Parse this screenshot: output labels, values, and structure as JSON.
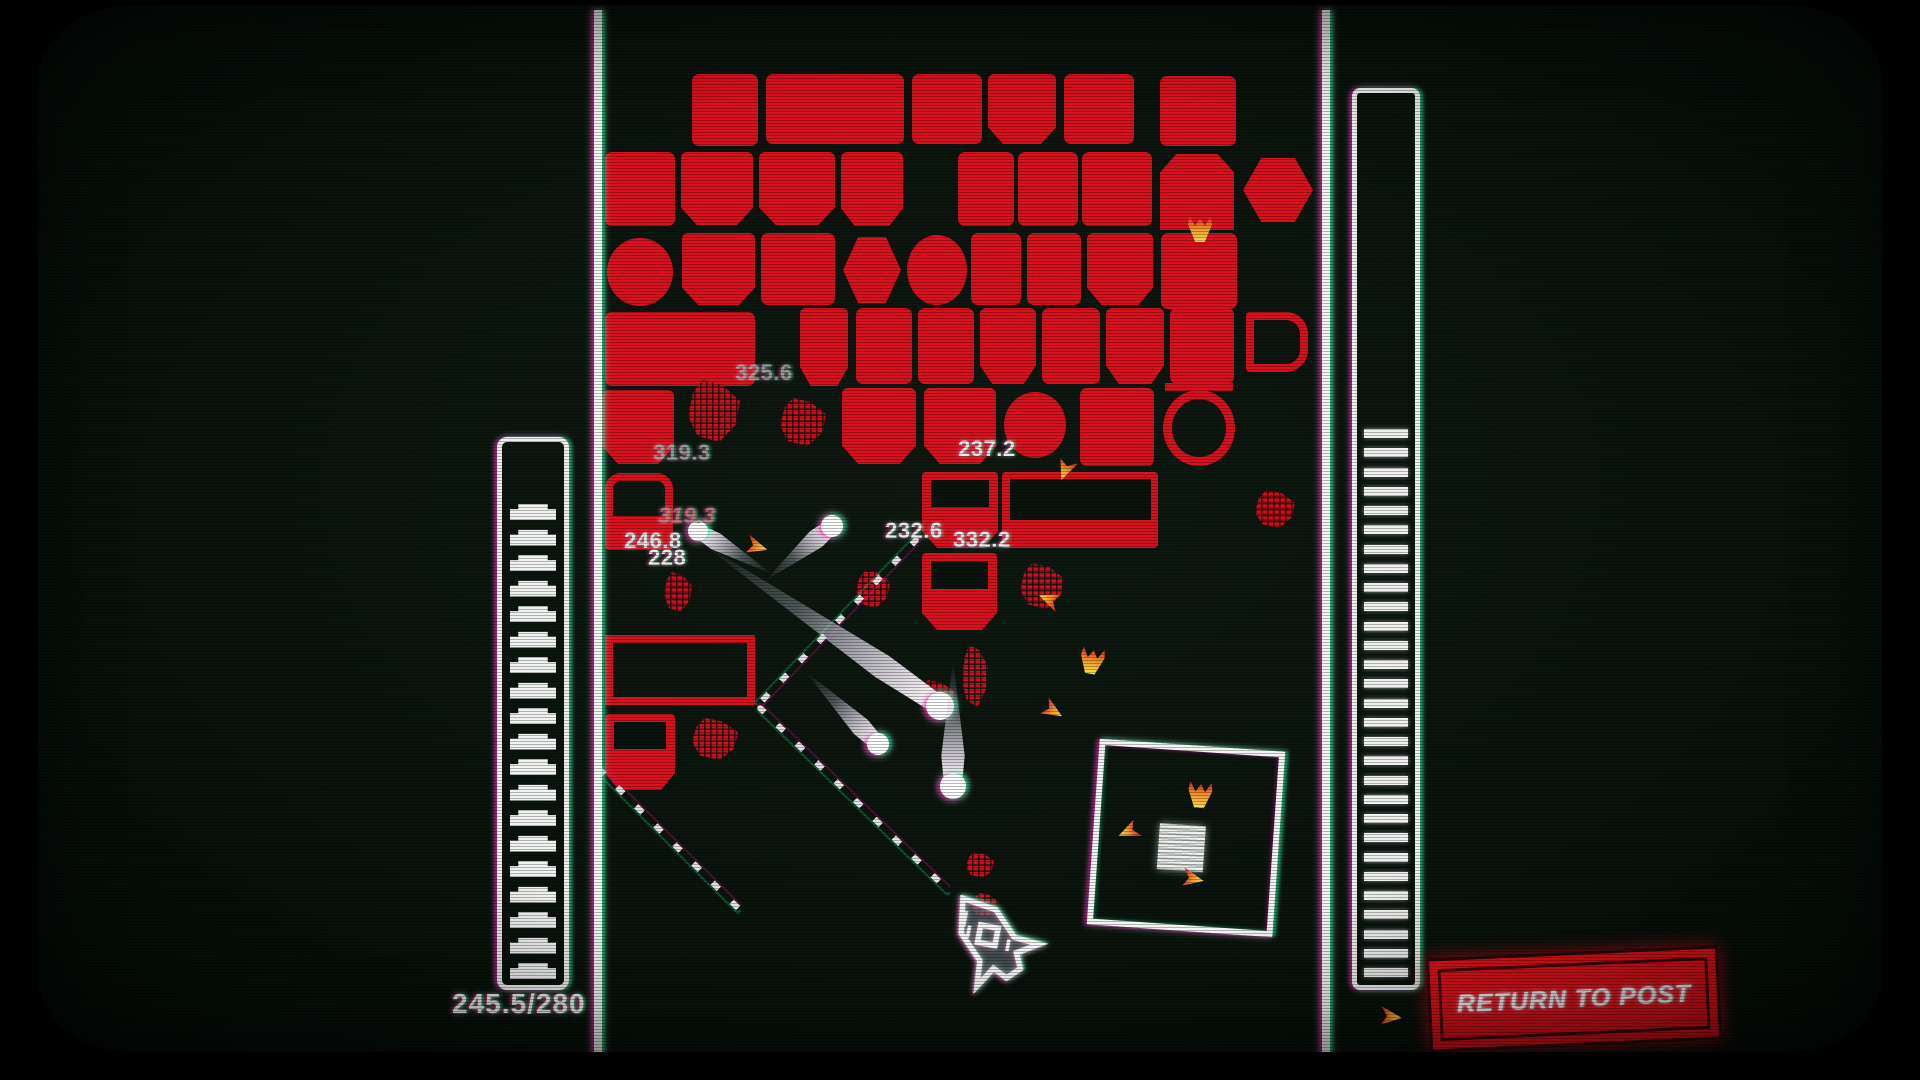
{
  "hud": {
    "ammo_label": "245.5/280",
    "ammo_segments": 19,
    "right_gauge_bars": 29,
    "return_button": "RETURN TO POST"
  },
  "colors": {
    "background": "#0a140d",
    "block_red": "#d8111e",
    "button_red": "#e8131d",
    "white": "#f2f4f3",
    "flame_orange": "#f08f25",
    "flame_yellow": "#ffe14e"
  },
  "walls": {
    "left_x": 594,
    "right_x": 1322
  },
  "labels": [
    {
      "text": "325.6",
      "x": 735,
      "y": 360,
      "cls": "dim"
    },
    {
      "text": "319.3",
      "x": 653,
      "y": 440,
      "cls": "dim"
    },
    {
      "text": "237.2",
      "x": 958,
      "y": 436,
      "cls": ""
    },
    {
      "text": "319.3",
      "x": 658,
      "y": 503,
      "cls": "ital"
    },
    {
      "text": "246.8",
      "x": 624,
      "y": 528,
      "cls": ""
    },
    {
      "text": "228",
      "x": 648,
      "y": 545,
      "cls": ""
    },
    {
      "text": "232.6",
      "x": 885,
      "y": 518,
      "cls": ""
    },
    {
      "text": "332.2",
      "x": 953,
      "y": 527,
      "cls": ""
    }
  ],
  "blocks": [
    {
      "x": 692,
      "y": 74,
      "w": 66,
      "h": 72,
      "s": "sq"
    },
    {
      "x": 766,
      "y": 74,
      "w": 138,
      "h": 70,
      "s": "sq"
    },
    {
      "x": 912,
      "y": 74,
      "w": 70,
      "h": 70,
      "s": "sq"
    },
    {
      "x": 988,
      "y": 74,
      "w": 68,
      "h": 70,
      "s": "octb"
    },
    {
      "x": 1064,
      "y": 74,
      "w": 70,
      "h": 70,
      "s": "sq"
    },
    {
      "x": 1160,
      "y": 76,
      "w": 76,
      "h": 70,
      "s": "sq"
    },
    {
      "x": 605,
      "y": 152,
      "w": 70,
      "h": 74,
      "s": "sq"
    },
    {
      "x": 681,
      "y": 152,
      "w": 72,
      "h": 73,
      "s": "octb"
    },
    {
      "x": 759,
      "y": 152,
      "w": 76,
      "h": 73,
      "s": "octb"
    },
    {
      "x": 841,
      "y": 152,
      "w": 62,
      "h": 74,
      "s": "octb"
    },
    {
      "x": 958,
      "y": 152,
      "w": 56,
      "h": 74,
      "s": "sq"
    },
    {
      "x": 1018,
      "y": 152,
      "w": 60,
      "h": 74,
      "s": "sq"
    },
    {
      "x": 1082,
      "y": 152,
      "w": 70,
      "h": 74,
      "s": "sq"
    },
    {
      "x": 1160,
      "y": 154,
      "w": 74,
      "h": 76,
      "s": "octt"
    },
    {
      "x": 1243,
      "y": 158,
      "w": 70,
      "h": 64,
      "s": "hex"
    },
    {
      "x": 607,
      "y": 238,
      "w": 66,
      "h": 68,
      "s": "circle"
    },
    {
      "x": 682,
      "y": 233,
      "w": 73,
      "h": 72,
      "s": "octb"
    },
    {
      "x": 761,
      "y": 233,
      "w": 74,
      "h": 72,
      "s": "sq"
    },
    {
      "x": 843,
      "y": 237,
      "w": 58,
      "h": 66,
      "s": "hex"
    },
    {
      "x": 907,
      "y": 235,
      "w": 60,
      "h": 70,
      "s": "circle"
    },
    {
      "x": 971,
      "y": 233,
      "w": 50,
      "h": 72,
      "s": "sq"
    },
    {
      "x": 1027,
      "y": 233,
      "w": 54,
      "h": 72,
      "s": "sq"
    },
    {
      "x": 1087,
      "y": 233,
      "w": 66,
      "h": 72,
      "s": "octb"
    },
    {
      "x": 1161,
      "y": 233,
      "w": 76,
      "h": 76,
      "s": "sq"
    },
    {
      "x": 605,
      "y": 312,
      "w": 150,
      "h": 74,
      "s": "sq"
    },
    {
      "x": 800,
      "y": 308,
      "w": 48,
      "h": 78,
      "s": "octb"
    },
    {
      "x": 856,
      "y": 308,
      "w": 56,
      "h": 76,
      "s": "sq"
    },
    {
      "x": 918,
      "y": 308,
      "w": 56,
      "h": 76,
      "s": "sq"
    },
    {
      "x": 980,
      "y": 308,
      "w": 56,
      "h": 76,
      "s": "octb"
    },
    {
      "x": 1042,
      "y": 308,
      "w": 58,
      "h": 76,
      "s": "sq"
    },
    {
      "x": 1106,
      "y": 308,
      "w": 58,
      "h": 76,
      "s": "octb"
    },
    {
      "x": 1170,
      "y": 308,
      "w": 64,
      "h": 76,
      "s": "sq"
    },
    {
      "x": 1246,
      "y": 312,
      "w": 62,
      "h": 60,
      "s": "dshape"
    },
    {
      "x": 602,
      "y": 390,
      "w": 72,
      "h": 74,
      "s": "octb"
    },
    {
      "x": 842,
      "y": 388,
      "w": 74,
      "h": 76,
      "s": "octb"
    },
    {
      "x": 924,
      "y": 388,
      "w": 72,
      "h": 76,
      "s": "octb"
    },
    {
      "x": 1004,
      "y": 392,
      "w": 62,
      "h": 66,
      "s": "circle"
    },
    {
      "x": 1080,
      "y": 388,
      "w": 74,
      "h": 78,
      "s": "sq"
    },
    {
      "x": 1163,
      "y": 390,
      "w": 72,
      "h": 76,
      "s": "ring"
    },
    {
      "x": 605,
      "y": 473,
      "w": 68,
      "h": 77,
      "s": "door"
    },
    {
      "x": 922,
      "y": 472,
      "w": 76,
      "h": 76,
      "s": "winb"
    },
    {
      "x": 1002,
      "y": 472,
      "w": 156,
      "h": 76,
      "s": "slot"
    },
    {
      "x": 922,
      "y": 553,
      "w": 75,
      "h": 77,
      "s": "winb"
    },
    {
      "x": 605,
      "y": 635,
      "w": 150,
      "h": 70,
      "s": "outline"
    },
    {
      "x": 605,
      "y": 714,
      "w": 70,
      "h": 76,
      "s": "winb"
    }
  ],
  "debris": [
    {
      "x": 688,
      "y": 380,
      "w": 52,
      "h": 62
    },
    {
      "x": 780,
      "y": 398,
      "w": 46,
      "h": 48
    },
    {
      "x": 664,
      "y": 572,
      "w": 28,
      "h": 40
    },
    {
      "x": 692,
      "y": 718,
      "w": 46,
      "h": 42
    },
    {
      "x": 1020,
      "y": 563,
      "w": 44,
      "h": 46
    },
    {
      "x": 1255,
      "y": 490,
      "w": 40,
      "h": 38
    },
    {
      "x": 856,
      "y": 570,
      "w": 34,
      "h": 38
    },
    {
      "x": 962,
      "y": 645,
      "w": 26,
      "h": 62
    },
    {
      "x": 966,
      "y": 852,
      "w": 28,
      "h": 26
    },
    {
      "x": 972,
      "y": 893,
      "w": 26,
      "h": 24
    },
    {
      "x": 918,
      "y": 680,
      "w": 36,
      "h": 34
    }
  ],
  "particles": [
    {
      "x": 1188,
      "y": 216,
      "t": "flame",
      "rot": 0
    },
    {
      "x": 1055,
      "y": 460,
      "t": "tri",
      "rot": 115
    },
    {
      "x": 746,
      "y": 536,
      "t": "tri",
      "rot": 20
    },
    {
      "x": 1038,
      "y": 590,
      "t": "tri",
      "rot": 205
    },
    {
      "x": 1080,
      "y": 648,
      "t": "flame",
      "rot": 10
    },
    {
      "x": 1042,
      "y": 700,
      "t": "tri",
      "rot": 35
    },
    {
      "x": 1188,
      "y": 782,
      "t": "flame",
      "rot": 5
    },
    {
      "x": 1118,
      "y": 822,
      "t": "tri",
      "rot": 160
    },
    {
      "x": 1182,
      "y": 868,
      "t": "tri",
      "rot": 15
    },
    {
      "x": 1380,
      "y": 1006,
      "t": "tri",
      "rot": 10
    }
  ],
  "comets": [
    {
      "x1": 700,
      "y1": 542,
      "x2": 940,
      "y2": 706,
      "r": 14
    },
    {
      "x1": 953,
      "y1": 660,
      "x2": 953,
      "y2": 786,
      "r": 13
    },
    {
      "x1": 806,
      "y1": 672,
      "x2": 878,
      "y2": 744,
      "r": 11
    },
    {
      "x1": 766,
      "y1": 580,
      "x2": 832,
      "y2": 526,
      "r": 11
    },
    {
      "x1": 772,
      "y1": 574,
      "x2": 698,
      "y2": 531,
      "r": 10
    }
  ],
  "trajectories": [
    {
      "x1": 918,
      "y1": 538,
      "x2": 758,
      "y2": 705
    },
    {
      "x1": 758,
      "y1": 706,
      "x2": 950,
      "y2": 892
    },
    {
      "x1": 598,
      "y1": 768,
      "x2": 740,
      "y2": 910
    }
  ],
  "square_outline": {
    "x": 1093,
    "y": 745,
    "size": 186,
    "rot": 4,
    "core_dx": 60,
    "core_dy": 74,
    "core_size": 46
  },
  "ship": {
    "x": 944,
    "y": 886,
    "w": 92,
    "h": 100,
    "rot": -34
  }
}
